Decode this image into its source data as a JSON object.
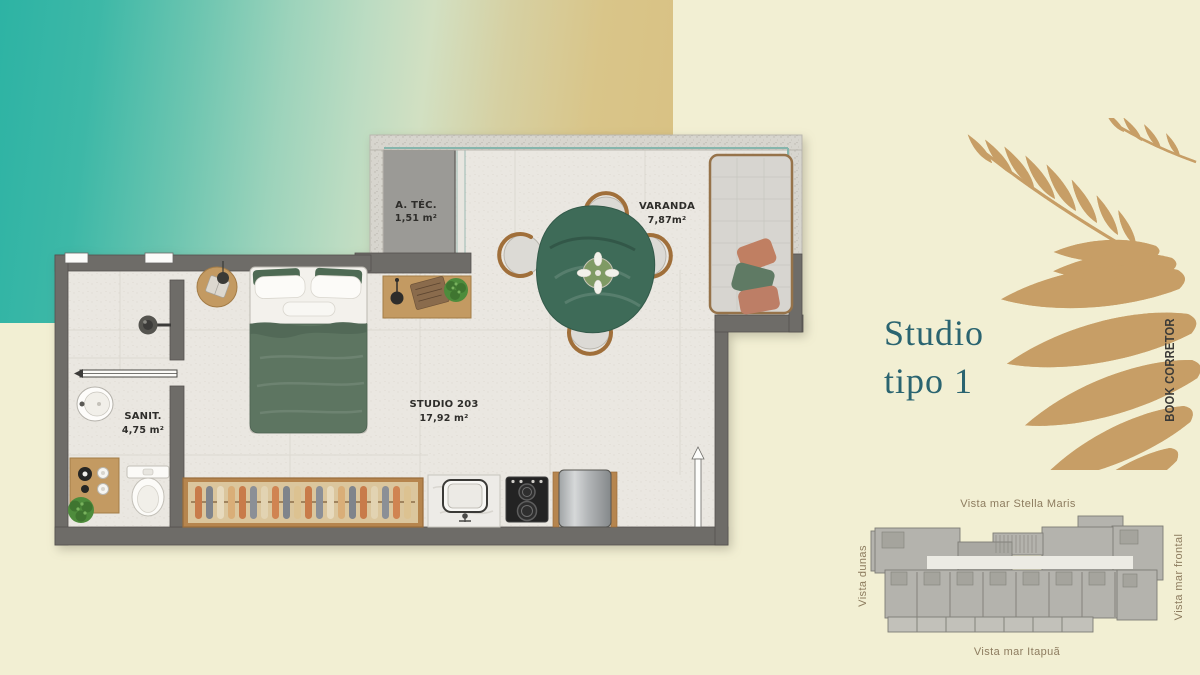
{
  "title": {
    "line1": "Studio",
    "line2": "tipo 1"
  },
  "side_label": "BOOK CORRETOR",
  "floor_plan": {
    "rooms": [
      {
        "name": "A. TÉC.",
        "area": "1,51 m²"
      },
      {
        "name": "VARANDA",
        "area": "7,87m²"
      },
      {
        "name": "SANIT.",
        "area": "4,75 m²"
      },
      {
        "name": "STUDIO 203",
        "area": "17,92 m²"
      }
    ]
  },
  "key_plan": {
    "top_label": "Vista mar Stella Maris",
    "left_label": "Vista dunas",
    "right_label": "Vista mar frontal",
    "bottom_label": "Vista mar Itapuã"
  },
  "colors": {
    "canvas": "#f2efd3",
    "gradient_teal": "#2db3a4",
    "gradient_sand": "#d9c183",
    "title_teal": "#2a6470",
    "leaf_gold": "#c79e66",
    "wall_dark": "#6e6c68",
    "wall_light": "#d7d5ce",
    "label_brown": "#8d7c5f"
  }
}
